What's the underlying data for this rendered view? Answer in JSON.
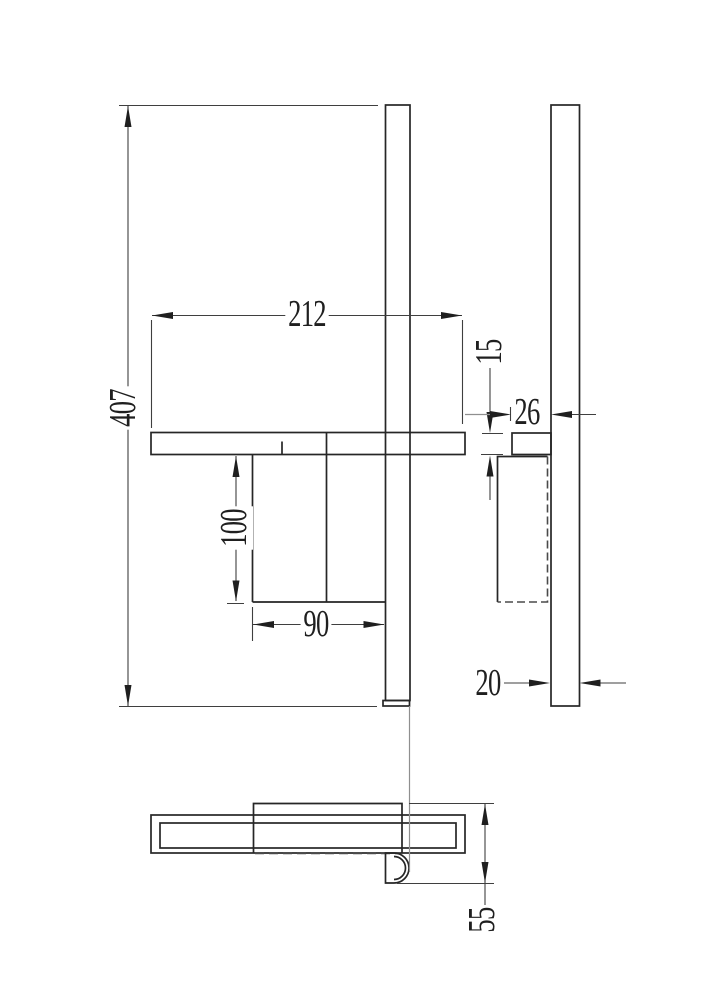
{
  "dimensions": {
    "overall_height": "407",
    "shelf_length": "212",
    "shelf_thickness": "15",
    "shelf_depth": "26",
    "bracket_drop": "100",
    "bracket_width": "90",
    "rail_thickness": "20",
    "mount_depth": "55"
  },
  "colors": {
    "background": "#ffffff",
    "object_line": "#262626",
    "dimension_line": "#3f3f3f",
    "hidden_line": "#4a4a4a",
    "projection_line": "#8f8f8f",
    "text": "#1f1f1f"
  }
}
